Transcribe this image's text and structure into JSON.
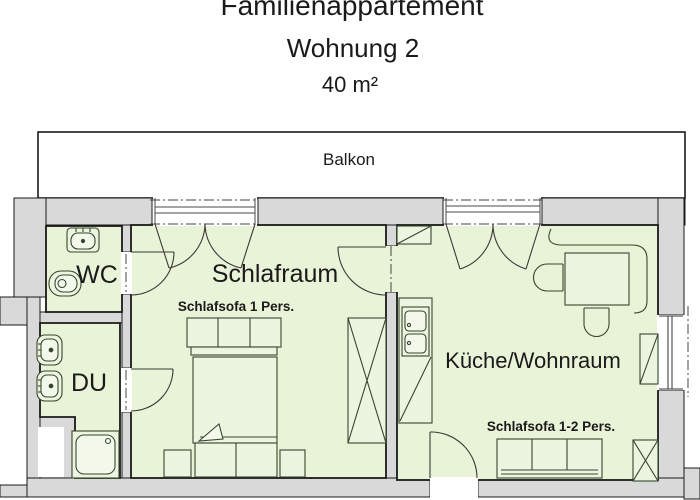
{
  "title": {
    "line1": "Familienappartement",
    "line2": "Wohnung 2",
    "area": "40 m²"
  },
  "rooms": {
    "balcony": "Balkon",
    "wc": "WC",
    "shower": "DU",
    "bedroom": "Schlafraum",
    "kitchen_living": "Küche/Wohnraum"
  },
  "furniture_labels": {
    "bedroom_sofa": "Schlafsofa 1 Pers.",
    "kitchen_sofa": "Schlafsofa  1-2 Pers."
  },
  "colors": {
    "room_fill": "#e8f3d8",
    "furniture_fill": "#ecf5df",
    "fixture_fill": "#f2f8ea",
    "wall_fill": "#d9d9d9",
    "outline": "#1a1a1a",
    "furniture_stroke": "#39452f",
    "background": "#ffffff"
  }
}
